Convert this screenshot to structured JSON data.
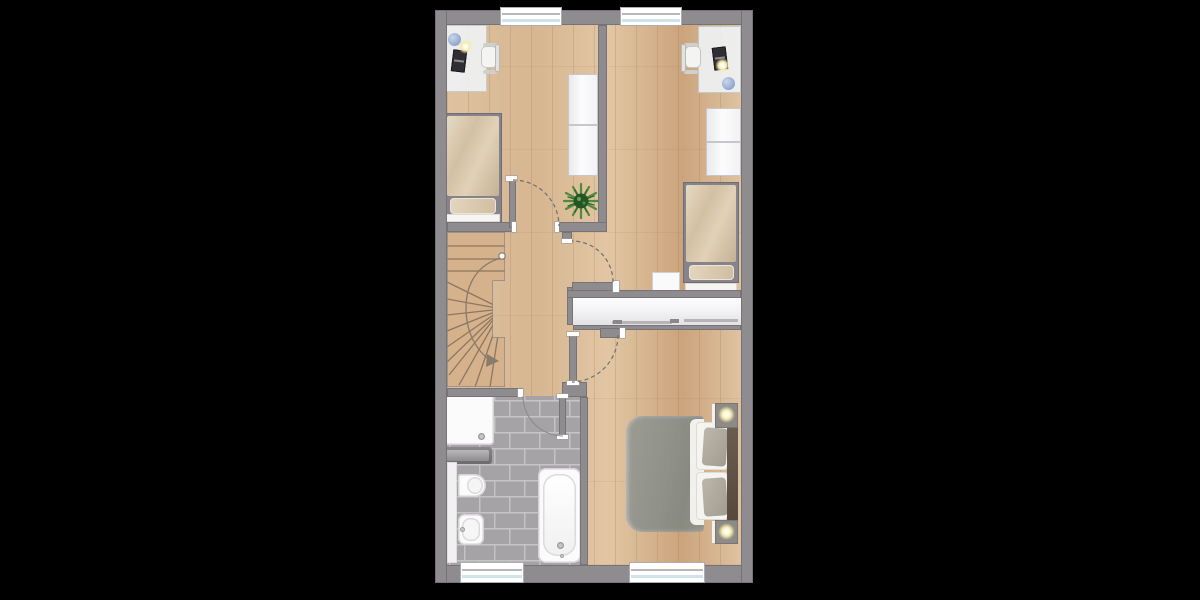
{
  "meta": {
    "kind": "floor-plan",
    "description": "upper-floor apartment plan, top-down view, no text labels"
  },
  "colors": {
    "background": "#000000",
    "wall": "#8F8C8F",
    "wall_edge": "#767376",
    "wood_light": "#DFC2A0",
    "wood_mid": "#D7B691",
    "wood_dark": "#CBA47C",
    "stair_wood": "#D5B28C",
    "stair_tread": "#8D7660",
    "tile": "#A6A3A6",
    "grout": "#C6C4C6",
    "fixture_white": "#FBFBFB",
    "fixture_edge": "#D5D3D5",
    "bed_beige": "#D3C0A4",
    "bed_beige_light": "#E6D9C2",
    "master_duvet": "#90928A",
    "headboard_wood": "#57493C",
    "plant_green": "#4E8A3F",
    "plant_dark": "#245522",
    "lamp_glow": "#F7E9AE",
    "window_glass": "#CFE3EA",
    "door_arc": "#6F6F6F"
  },
  "inventory": {
    "rooms": [
      {
        "name": "bedroom-1",
        "position": "top-left",
        "furniture": [
          "desk",
          "desk-chair",
          "laptop",
          "desk-lamp",
          "blue-decor",
          "wardrobe",
          "single-bed",
          "plant"
        ]
      },
      {
        "name": "bedroom-2",
        "position": "top-right",
        "furniture": [
          "desk",
          "desk-chair",
          "laptop",
          "desk-lamp",
          "blue-decor",
          "wardrobe",
          "single-bed",
          "side-table"
        ]
      },
      {
        "name": "landing-hallway",
        "position": "center-left",
        "furniture": [
          "winder-staircase"
        ]
      },
      {
        "name": "built-in-closet",
        "position": "center-right",
        "furniture": [
          "sliding-doors"
        ]
      },
      {
        "name": "bathroom",
        "position": "bottom-left",
        "furniture": [
          "shower-tray",
          "radiator",
          "wall-toilet",
          "bidet",
          "bathtub",
          "side-shelf"
        ]
      },
      {
        "name": "master-bedroom",
        "position": "bottom-right",
        "furniture": [
          "double-bed",
          "headboard",
          "nightstand-with-lamp",
          "nightstand-with-lamp"
        ]
      }
    ],
    "windows": 4,
    "doors": 4,
    "stairs": {
      "type": "winder",
      "turn": "half-turn",
      "walkline_marker": "circle-to-arrow"
    }
  },
  "geometry": {
    "plan": {
      "x": 435,
      "y": 10,
      "w": 318,
      "h": 573
    },
    "rects": [
      {
        "n": "wood-floor",
        "c": "floor-wood floor",
        "x": 12,
        "y": 15,
        "w": 294,
        "h": 540
      },
      {
        "n": "closet-interior",
        "c": "closet-int",
        "x": 138,
        "y": 288,
        "w": 168,
        "h": 27
      },
      {
        "n": "bedroom1-desk",
        "c": "desk",
        "x": 11,
        "y": 15,
        "w": 41,
        "h": 67
      },
      {
        "n": "bedroom1-blue-decor",
        "c": "decor-blue",
        "x": 13,
        "y": 23,
        "w": 13,
        "h": 13
      },
      {
        "n": "bedroom1-desk-lamp",
        "c": "lamp-glow",
        "x": 23,
        "y": 29,
        "w": 15,
        "h": 15
      },
      {
        "n": "bedroom1-laptop",
        "c": "laptop rot-l",
        "x": 17,
        "y": 40,
        "w": 14,
        "h": 22
      },
      {
        "n": "bedroom1-chair-arm-top",
        "c": "chair-arm",
        "x": 48,
        "y": 33,
        "w": 14,
        "h": 4
      },
      {
        "n": "bedroom1-chair-arm-bot",
        "c": "chair-arm",
        "x": 48,
        "y": 60,
        "w": 14,
        "h": 4
      },
      {
        "n": "bedroom1-chair-seat",
        "c": "chair-seat",
        "x": 46,
        "y": 36,
        "w": 16,
        "h": 22
      },
      {
        "n": "bedroom1-chair-back",
        "c": "chair-back",
        "x": 60,
        "y": 34,
        "w": 5,
        "h": 28
      },
      {
        "n": "bedroom1-wardrobe",
        "c": "wardrobe",
        "x": 133,
        "y": 64,
        "w": 30,
        "h": 102
      },
      {
        "n": "bedroom1-wardrobe-divider",
        "c": "wardrobe-div",
        "x": 133,
        "y": 114,
        "w": 30,
        "h": 2
      },
      {
        "n": "bedroom1-bed-frame",
        "c": "bedframe",
        "x": 9,
        "y": 103,
        "w": 58,
        "h": 109
      },
      {
        "n": "bedroom1-bed-duvet",
        "c": "duvet",
        "x": 12,
        "y": 106,
        "w": 52,
        "h": 80
      },
      {
        "n": "bedroom1-bed-pillow",
        "c": "pillow",
        "x": 15,
        "y": 188,
        "w": 46,
        "h": 16
      },
      {
        "n": "bedroom1-bed-foot",
        "c": "bed-foot",
        "x": 11,
        "y": 204,
        "w": 54,
        "h": 8
      },
      {
        "n": "bedroom2-desk",
        "c": "desk",
        "x": 263,
        "y": 16,
        "w": 43,
        "h": 67
      },
      {
        "n": "bedroom2-desk-lamp",
        "c": "lamp-glow",
        "x": 280,
        "y": 48,
        "w": 15,
        "h": 15
      },
      {
        "n": "bedroom2-laptop",
        "c": "laptop rot-r",
        "x": 278,
        "y": 37,
        "w": 14,
        "h": 23
      },
      {
        "n": "bedroom2-blue-decor",
        "c": "decor-blue",
        "x": 287,
        "y": 67,
        "w": 13,
        "h": 13
      },
      {
        "n": "bedroom2-chair-arm-top",
        "c": "chair-arm",
        "x": 249,
        "y": 33,
        "w": 14,
        "h": 4
      },
      {
        "n": "bedroom2-chair-arm-bot",
        "c": "chair-arm",
        "x": 249,
        "y": 60,
        "w": 14,
        "h": 4
      },
      {
        "n": "bedroom2-chair-seat",
        "c": "chair-seat",
        "x": 250,
        "y": 36,
        "w": 16,
        "h": 22
      },
      {
        "n": "bedroom2-chair-back",
        "c": "chair-back",
        "x": 246,
        "y": 34,
        "w": 5,
        "h": 28
      },
      {
        "n": "bedroom2-wardrobe",
        "c": "wardrobe",
        "x": 271,
        "y": 98,
        "w": 35,
        "h": 68
      },
      {
        "n": "bedroom2-wardrobe-divider",
        "c": "wardrobe-div",
        "x": 271,
        "y": 131,
        "w": 35,
        "h": 2
      },
      {
        "n": "bedroom2-bed-frame",
        "c": "bedframe",
        "x": 248,
        "y": 172,
        "w": 56,
        "h": 101
      },
      {
        "n": "bedroom2-bed-duvet",
        "c": "duvet",
        "x": 251,
        "y": 175,
        "w": 50,
        "h": 77
      },
      {
        "n": "bedroom2-bed-pillow",
        "c": "pillow",
        "x": 254,
        "y": 255,
        "w": 45,
        "h": 15
      },
      {
        "n": "bedroom2-bed-foot",
        "c": "bed-foot",
        "x": 250,
        "y": 273,
        "w": 52,
        "h": 9
      },
      {
        "n": "bedroom2-side-table",
        "c": "table",
        "x": 217,
        "y": 262,
        "w": 28,
        "h": 21
      },
      {
        "n": "master-bed-duvet",
        "c": "m-duvet",
        "x": 191,
        "y": 406,
        "w": 78,
        "h": 116
      },
      {
        "n": "master-bed-sheet",
        "c": "m-sheet",
        "x": 255,
        "y": 409,
        "w": 14,
        "h": 106
      },
      {
        "n": "master-pillow-white-1",
        "c": "m-pillow-w",
        "x": 261,
        "y": 412,
        "w": 32,
        "h": 48
      },
      {
        "n": "master-pillow-white-2",
        "c": "m-pillow-w",
        "x": 261,
        "y": 462,
        "w": 32,
        "h": 48
      },
      {
        "n": "master-pillow-gray-1",
        "c": "m-pillow-g tilt-a",
        "x": 268,
        "y": 418,
        "w": 24,
        "h": 38
      },
      {
        "n": "master-pillow-gray-2",
        "c": "m-pillow-g tilt-b",
        "x": 268,
        "y": 468,
        "w": 24,
        "h": 38
      },
      {
        "n": "master-headboard",
        "c": "headboard",
        "x": 292,
        "y": 414,
        "w": 11,
        "h": 96
      },
      {
        "n": "master-nightstand-1",
        "c": "nightstand",
        "x": 280,
        "y": 393,
        "w": 23,
        "h": 25
      },
      {
        "n": "master-lamp-1",
        "c": "lamp-glow",
        "x": 283,
        "y": 396,
        "w": 17,
        "h": 17
      },
      {
        "n": "master-nightstand-2",
        "c": "nightstand",
        "x": 280,
        "y": 510,
        "w": 23,
        "h": 24
      },
      {
        "n": "master-lamp-2",
        "c": "lamp-glow",
        "x": 283,
        "y": 513,
        "w": 17,
        "h": 17
      },
      {
        "n": "bath-shower-tray",
        "c": "white-fixture shower",
        "x": 9,
        "y": 384,
        "w": 50,
        "h": 51
      },
      {
        "n": "bath-shower-drain",
        "c": "drain",
        "x": 43,
        "y": 423,
        "w": 7,
        "h": 7
      },
      {
        "n": "bath-radiator",
        "c": "radiator",
        "x": 8,
        "y": 437,
        "w": 49,
        "h": 17
      },
      {
        "n": "bath-radiator-inner",
        "c": "radiator-inner",
        "x": 11,
        "y": 440,
        "w": 43,
        "h": 11
      },
      {
        "n": "bath-side-shelf",
        "c": "shelf",
        "x": 12,
        "y": 452,
        "w": 10,
        "h": 101
      },
      {
        "n": "bath-toilet",
        "c": "white-fixture toilet",
        "x": 23,
        "y": 464,
        "w": 28,
        "h": 23
      },
      {
        "n": "bath-toilet-seat",
        "c": "toilet-seat",
        "x": 32,
        "y": 467,
        "w": 16,
        "h": 17
      },
      {
        "n": "bath-bidet",
        "c": "white-fixture bidet",
        "x": 23,
        "y": 504,
        "w": 26,
        "h": 31
      },
      {
        "n": "bath-bidet-inner",
        "c": "bidet-inner",
        "x": 27,
        "y": 508,
        "w": 18,
        "h": 23
      },
      {
        "n": "bath-bidet-drain",
        "c": "drain",
        "x": 25,
        "y": 517,
        "w": 5,
        "h": 5
      },
      {
        "n": "bath-tub",
        "c": "white-fixture tub",
        "x": 103,
        "y": 458,
        "w": 43,
        "h": 95
      },
      {
        "n": "bath-tub-inner",
        "c": "tub-inner",
        "x": 108,
        "y": 464,
        "w": 33,
        "h": 82
      },
      {
        "n": "bath-tub-drain",
        "c": "drain",
        "x": 122,
        "y": 532,
        "w": 7,
        "h": 7
      },
      {
        "n": "bath-tub-faucet",
        "c": "drain",
        "x": 125,
        "y": 544,
        "w": 4,
        "h": 4
      },
      {
        "n": "wall-top",
        "c": "wall",
        "x": 0,
        "y": 0,
        "w": 318,
        "h": 15
      },
      {
        "n": "wall-bottom",
        "c": "wall",
        "x": 0,
        "y": 555,
        "w": 318,
        "h": 18
      },
      {
        "n": "wall-left",
        "c": "wall",
        "x": 0,
        "y": 0,
        "w": 12,
        "h": 573
      },
      {
        "n": "wall-right",
        "c": "wall",
        "x": 306,
        "y": 0,
        "w": 12,
        "h": 573
      },
      {
        "n": "wall-mid-bedrooms",
        "c": "wall",
        "x": 163,
        "y": 15,
        "w": 9,
        "h": 207
      },
      {
        "n": "wall-bedroom1-south-west",
        "c": "wall",
        "x": 12,
        "y": 212,
        "w": 69,
        "h": 10
      },
      {
        "n": "wall-bedroom1-south-east",
        "c": "wall",
        "x": 124,
        "y": 212,
        "w": 48,
        "h": 10
      },
      {
        "n": "wall-bedroom2-door-stub",
        "c": "wall",
        "x": 127,
        "y": 222,
        "w": 10,
        "h": 11
      },
      {
        "n": "wall-closet-left",
        "c": "wall",
        "x": 132,
        "y": 277,
        "w": 6,
        "h": 38
      },
      {
        "n": "wall-closet-top",
        "c": "wall",
        "x": 132,
        "y": 280,
        "w": 174,
        "h": 8
      },
      {
        "n": "wall-closet-bottom",
        "c": "wall",
        "x": 138,
        "y": 315,
        "w": 168,
        "h": 5
      },
      {
        "n": "wall-closet-bottom-bar",
        "c": "wall",
        "x": 165,
        "y": 318,
        "w": 22,
        "h": 10
      },
      {
        "n": "wall-master-stub",
        "c": "wall",
        "x": 127,
        "y": 372,
        "w": 25,
        "h": 15
      },
      {
        "n": "wall-bathroom-north",
        "c": "wall",
        "x": 12,
        "y": 378,
        "w": 76,
        "h": 9
      },
      {
        "n": "wall-bathroom-east",
        "c": "wall",
        "x": 145,
        "y": 387,
        "w": 8,
        "h": 168
      },
      {
        "n": "door-leaf-bedroom1",
        "c": "leaf",
        "x": 74,
        "y": 168,
        "w": 7,
        "h": 50
      },
      {
        "n": "door-cap-bedroom1-top",
        "c": "cap",
        "x": 71,
        "y": 166,
        "w": 11,
        "h": 5
      },
      {
        "n": "door-jamb-bedroom1-west",
        "c": "cap",
        "x": 77,
        "y": 212,
        "w": 4,
        "h": 10
      },
      {
        "n": "door-jamb-bedroom1-east",
        "c": "cap",
        "x": 120,
        "y": 212,
        "w": 4,
        "h": 10
      },
      {
        "n": "door-leaf-bedroom2",
        "c": "leaf",
        "x": 137,
        "y": 272,
        "w": 43,
        "h": 9
      },
      {
        "n": "door-cap-bedroom2-end",
        "c": "cap",
        "x": 178,
        "y": 271,
        "w": 6,
        "h": 11
      },
      {
        "n": "door-jamb-bedroom2-top",
        "c": "cap",
        "x": 127,
        "y": 229,
        "w": 10,
        "h": 4
      },
      {
        "n": "door-leaf-master",
        "c": "leaf",
        "x": 134,
        "y": 324,
        "w": 8,
        "h": 49
      },
      {
        "n": "door-cap-master-top",
        "c": "cap",
        "x": 132,
        "y": 322,
        "w": 12,
        "h": 4
      },
      {
        "n": "door-cap-master-bottom",
        "c": "cap",
        "x": 132,
        "y": 371,
        "w": 12,
        "h": 4
      },
      {
        "n": "door-cap-closet-bar",
        "c": "cap",
        "x": 185,
        "y": 318,
        "w": 5,
        "h": 10
      },
      {
        "n": "door-jamb-bathroom",
        "c": "cap",
        "x": 83,
        "y": 379,
        "w": 5,
        "h": 8
      },
      {
        "n": "door-leaf-bathroom",
        "c": "leaf",
        "x": 124,
        "y": 386,
        "w": 7,
        "h": 41
      },
      {
        "n": "door-cap-bathroom-top",
        "c": "cap",
        "x": 122,
        "y": 384,
        "w": 11,
        "h": 4
      },
      {
        "n": "door-cap-bathroom-bottom",
        "c": "cap",
        "x": 122,
        "y": 425,
        "w": 11,
        "h": 4
      },
      {
        "n": "closet-sliding-line-1",
        "c": "closet-line",
        "x": 177,
        "y": 311,
        "w": 60,
        "h": 3
      },
      {
        "n": "closet-handle-1",
        "c": "closet-handle",
        "x": 178,
        "y": 310,
        "w": 9,
        "h": 4
      },
      {
        "n": "closet-handle-2",
        "c": "closet-handle",
        "x": 235,
        "y": 309,
        "w": 9,
        "h": 4
      },
      {
        "n": "closet-sliding-line-2",
        "c": "closet-line",
        "x": 249,
        "y": 309,
        "w": 54,
        "h": 3
      },
      {
        "n": "window-bedroom1",
        "c": "window",
        "x": 66,
        "y": -2,
        "w": 60,
        "h": 17
      },
      {
        "n": "window-bedroom2",
        "c": "window",
        "x": 186,
        "y": -2,
        "w": 60,
        "h": 17
      },
      {
        "n": "window-bathroom",
        "c": "window",
        "x": 26,
        "y": 553,
        "w": 62,
        "h": 19
      },
      {
        "n": "window-master",
        "c": "window",
        "x": 195,
        "y": 553,
        "w": 74,
        "h": 19
      }
    ]
  }
}
